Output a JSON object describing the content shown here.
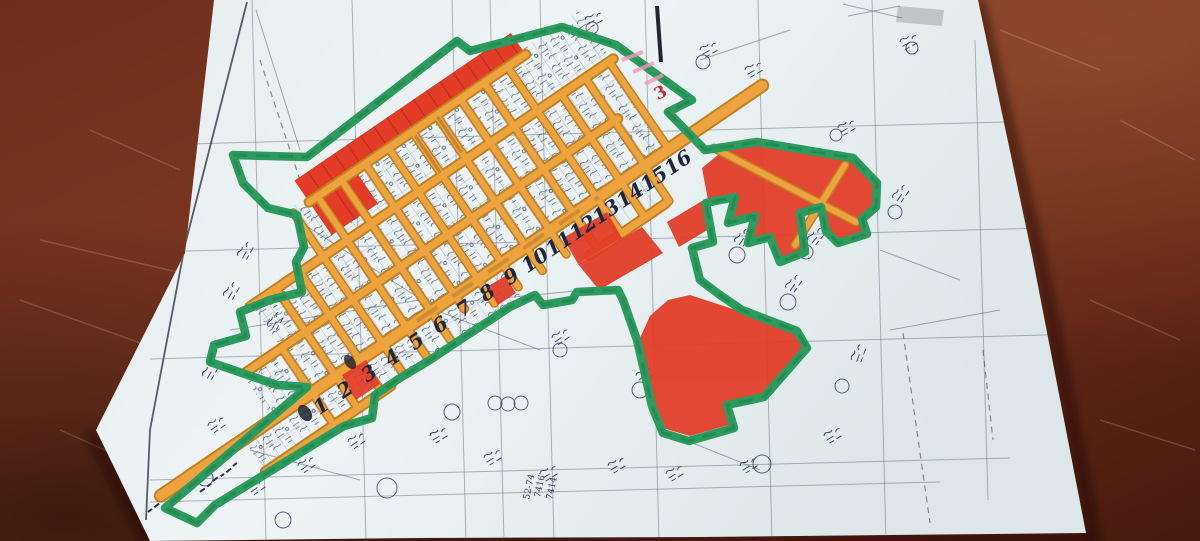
{
  "scene": {
    "type": "photograph",
    "subject": "Hand-coloured cadastral subdivision plan on white paper lying on a dark red-brown wooden table",
    "paper_color": "#ecf2f3",
    "table_color": "#6b2a1b"
  },
  "palette": {
    "boundary_green": "#2b9b5e",
    "road_orange": "#eda43e",
    "road_edge_orange": "#c2801f",
    "plot_red": "#e23b26",
    "print_ink": "#3c4660",
    "number_ink": "#1e2640",
    "annotation_red": "#c32b2c",
    "highlight_pink": "#ef9ab5"
  },
  "map": {
    "road_numbers": [
      "1",
      "2",
      "3",
      "4",
      "5",
      "6",
      "7",
      "8",
      "9",
      "10",
      "11",
      "12",
      "13",
      "14",
      "15",
      "16"
    ],
    "flag_mark": "3",
    "survey_numbers": [
      "7416",
      "7414",
      "52-74"
    ]
  }
}
